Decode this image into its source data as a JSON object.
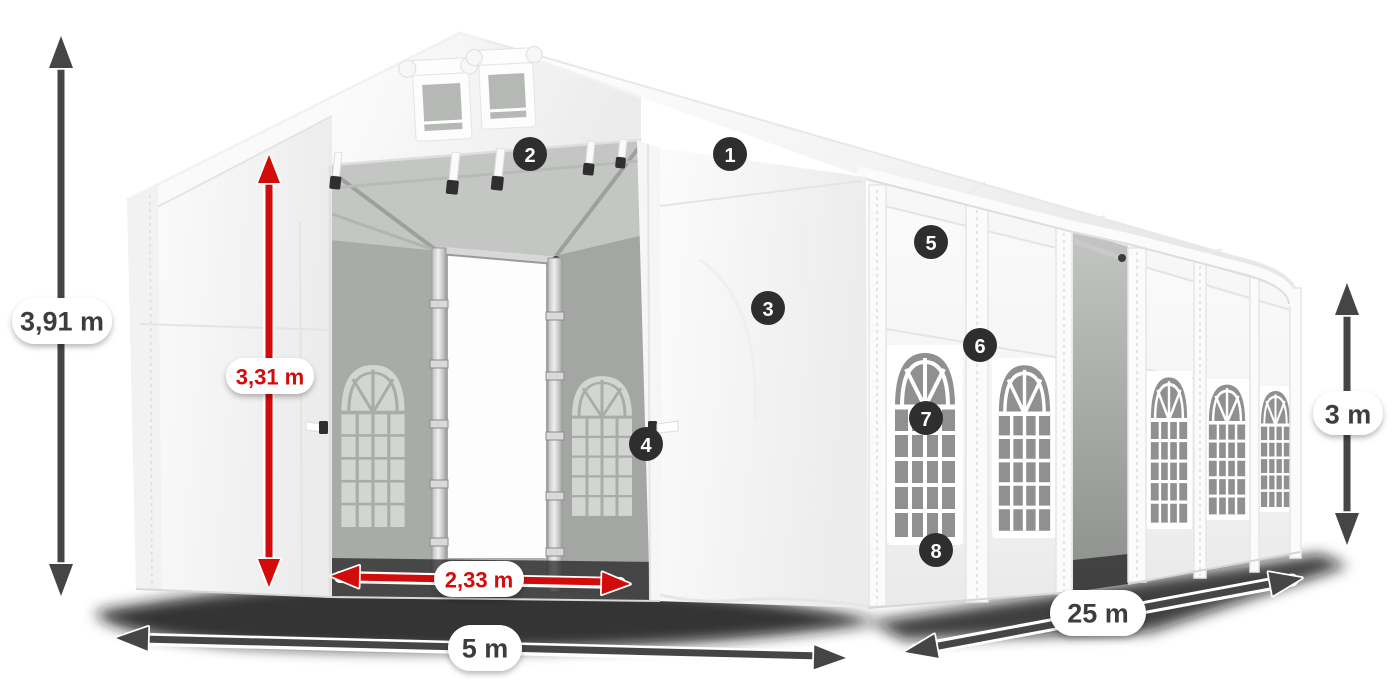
{
  "dimensions": {
    "ridge_height": "3,91 m",
    "inner_door_height": "3,31 m",
    "entrance_width": "2,33 m",
    "front_width": "5 m",
    "length": "25 m",
    "side_wall_height": "3 m"
  },
  "feature_badges": [
    {
      "number": "1"
    },
    {
      "number": "2"
    },
    {
      "number": "3"
    },
    {
      "number": "4"
    },
    {
      "number": "5"
    },
    {
      "number": "6"
    },
    {
      "number": "7"
    },
    {
      "number": "8"
    }
  ],
  "colors": {
    "dimension_red": "#d20b0b",
    "dimension_gray": "#454545",
    "label_text_gray": "#3d3d3d",
    "badge_background": "#2e2e2e",
    "badge_text": "#ffffff",
    "tent_white": "#fafafa",
    "interior_gray": "#adafad",
    "window_glass_gray": "#8f918f",
    "background": "#ffffff"
  }
}
